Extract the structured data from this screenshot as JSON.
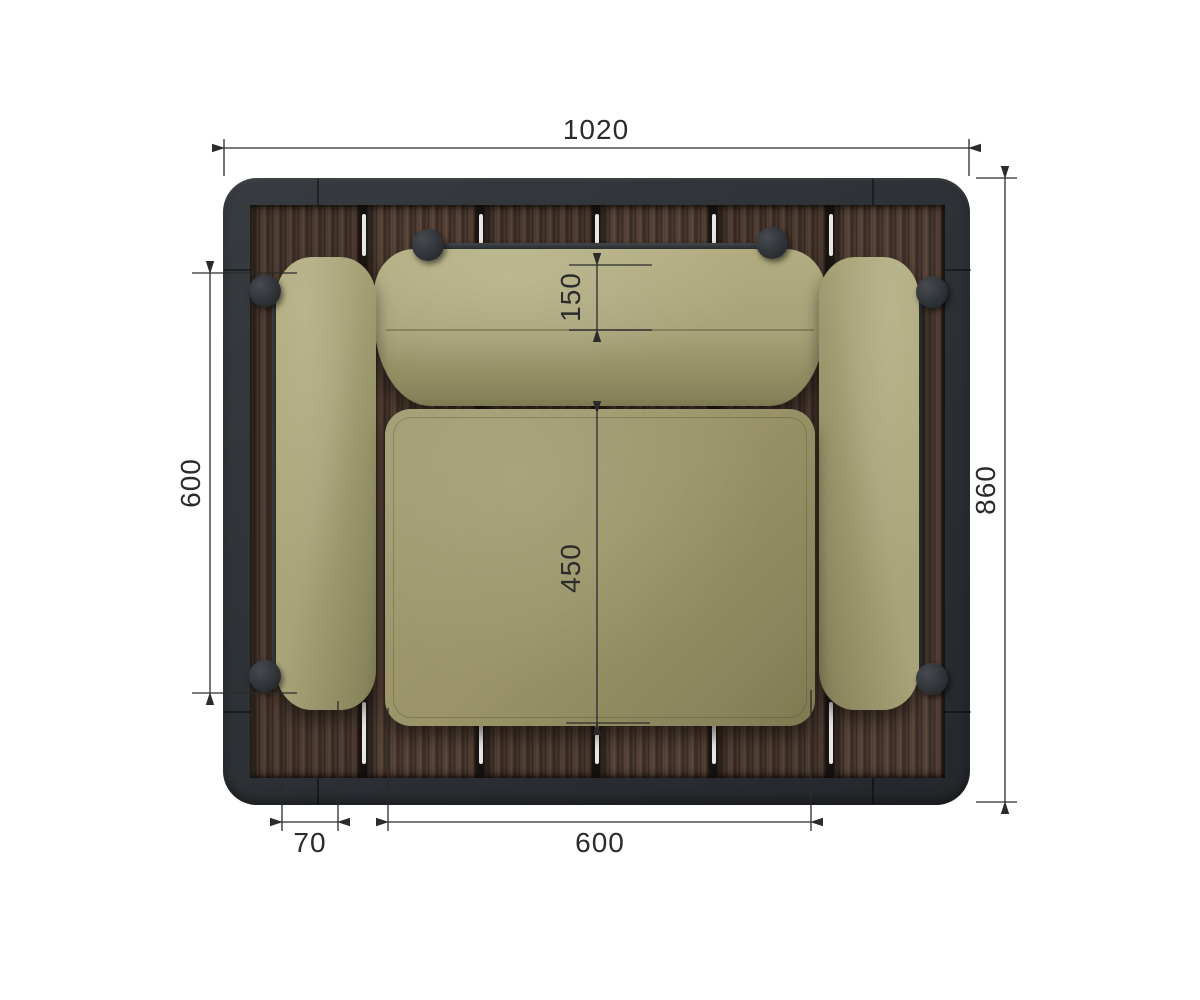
{
  "drawing": {
    "title": "armchair-top-view",
    "units": "mm",
    "dimensions": {
      "overall_width": "1020",
      "overall_depth": "860",
      "armrest_length": "600",
      "back_cushion_depth": "150",
      "seat_depth": "450",
      "armrest_width": "70",
      "seat_width": "600"
    }
  },
  "colors": {
    "bg": "#ffffff",
    "line": "#2b2b2b",
    "frame": "#2e3236",
    "frame-dark": "#24272b",
    "wood-base": "#46362e",
    "wood-dark": "#2f241f",
    "wood-light": "#5d4839",
    "gap-light": "#f8f8f6",
    "cushion": "#a8a378",
    "cushion-dark": "#807c55",
    "seat": "#9a9468",
    "seat-dark": "#7e794f",
    "metal": "#303438"
  }
}
